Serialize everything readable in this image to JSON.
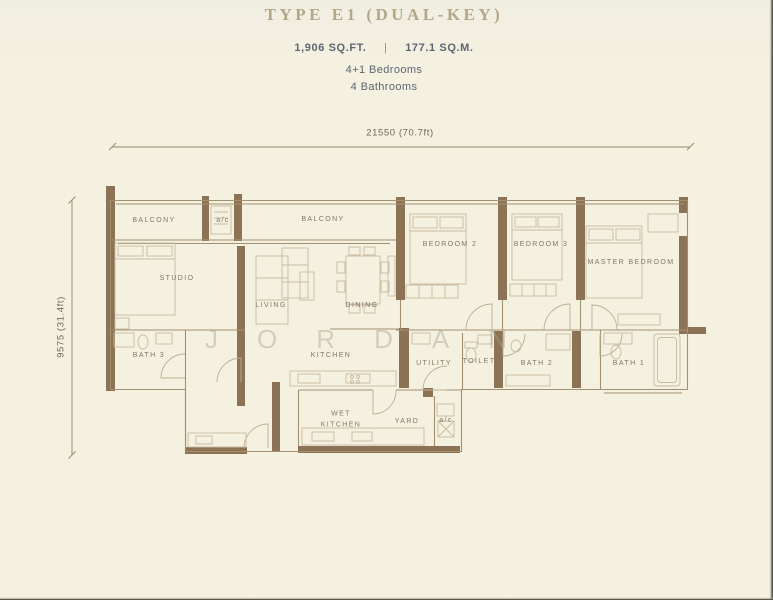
{
  "header": {
    "title": "TYPE E1 (DUAL-KEY)",
    "area_sqft": "1,906 SQ.FT.",
    "divider": "|",
    "area_sqm": "177.1 SQ.M.",
    "bedrooms": "4+1 Bedrooms",
    "bathrooms": "4 Bathrooms"
  },
  "dimensions": {
    "width": "21550 (70.7ft)",
    "height": "9575 (31.4ft)"
  },
  "watermark": {
    "letters": [
      "J",
      "O",
      "R",
      "D",
      "A",
      "N"
    ]
  },
  "rooms": {
    "balcony_left": "BALCONY",
    "ac_top": "a/c",
    "balcony_main": "BALCONY",
    "bedroom2": "BEDROOM 2",
    "bedroom3": "BEDROOM 3",
    "master_bedroom": "MASTER BEDROOM",
    "studio": "STUDIO",
    "living": "LIVING",
    "dining": "DINING",
    "bath3": "BATH 3",
    "kitchen": "KITCHEN",
    "utility": "UTILITY",
    "toilet": "TOILET",
    "bath2": "BATH 2",
    "bath1": "BATH 1",
    "wet_kitchen": "WET KITCHEN",
    "yard": "YARD",
    "ac_bottom": "a/c"
  },
  "colors": {
    "background": "#f5f1e0",
    "wall": "#8d7355",
    "thin_line": "#a2906f",
    "title": "#b2a789",
    "subtitle": "#5d6671",
    "room_label": "#807666"
  }
}
